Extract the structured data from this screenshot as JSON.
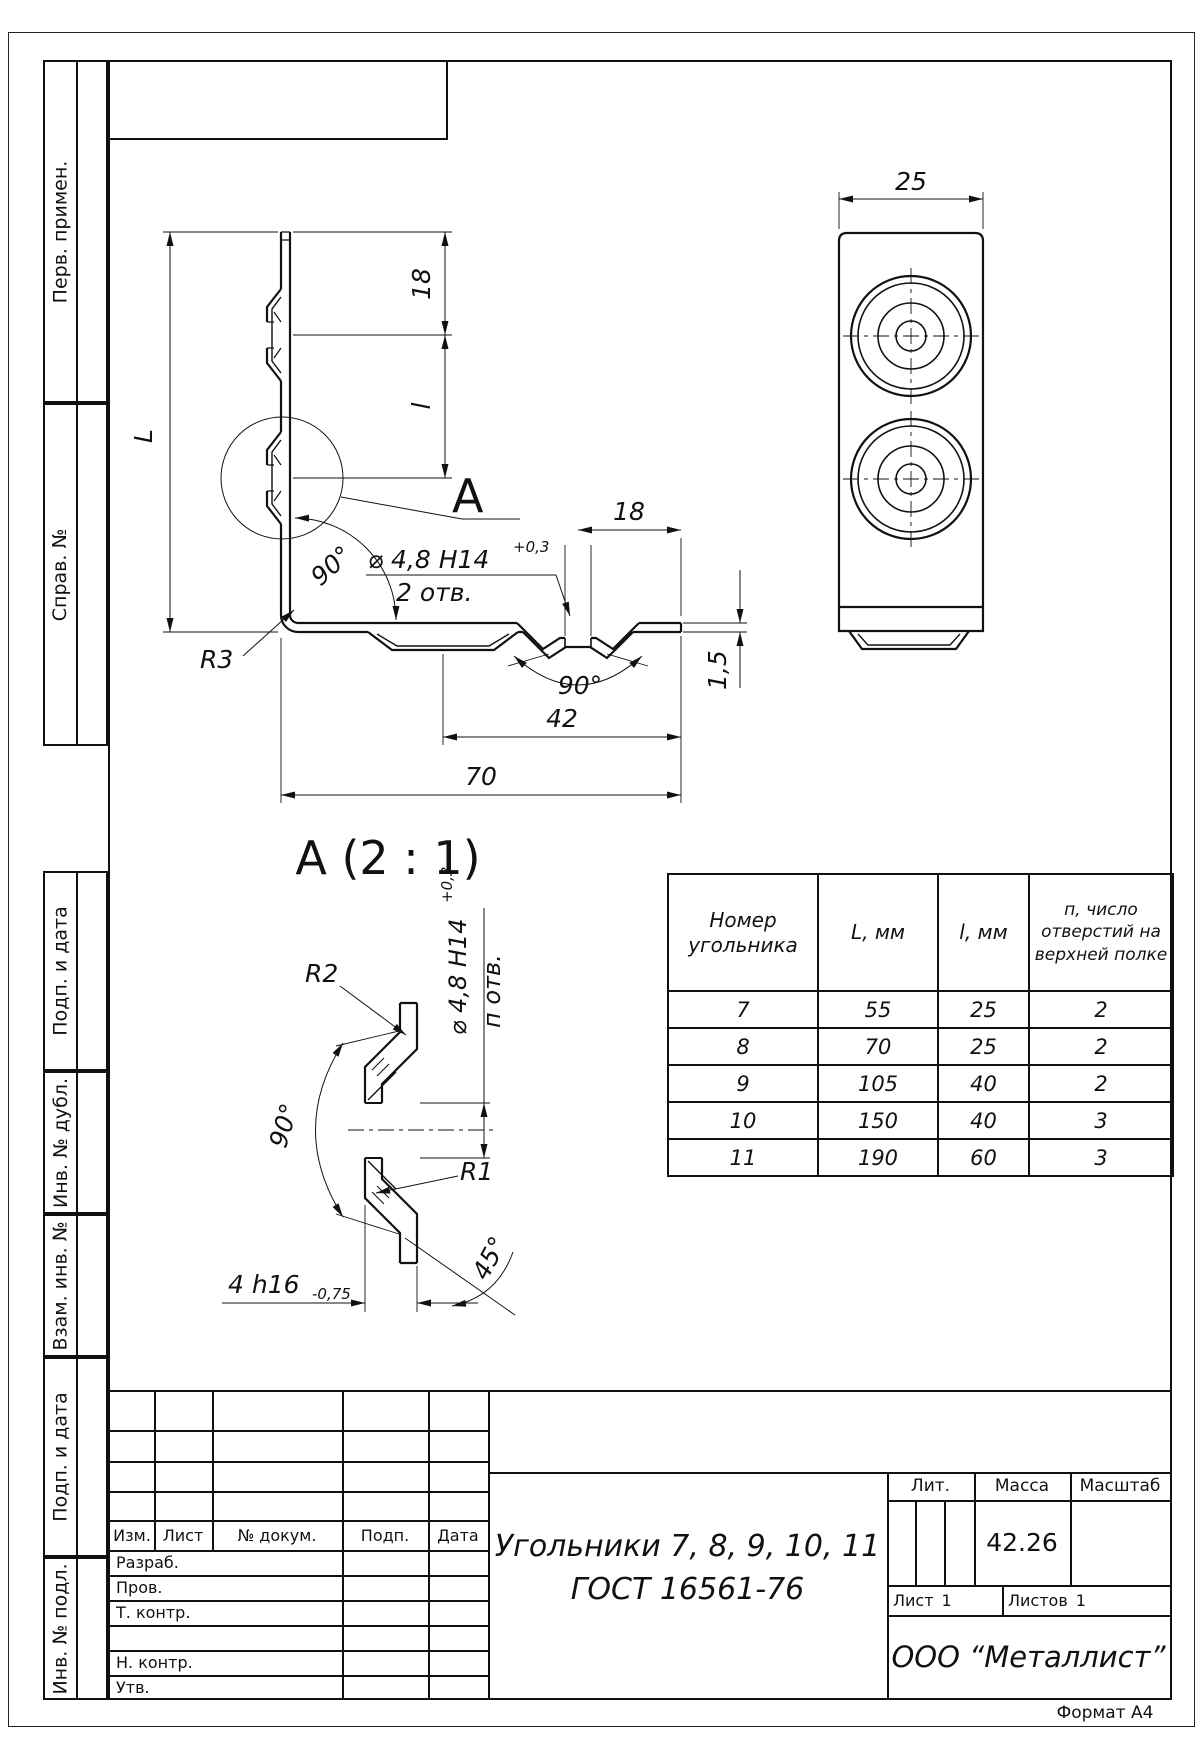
{
  "page": {
    "format_label": "Формат А4"
  },
  "left_margin": {
    "items": [
      {
        "label": "Перв. примен."
      },
      {
        "label": "Справ. №"
      },
      {
        "label": "Подп. и дата"
      },
      {
        "label": "Инв. № дубл."
      },
      {
        "label": "Взам. инв. №"
      },
      {
        "label": "Подп. и дата"
      },
      {
        "label": "Инв. № подл."
      }
    ]
  },
  "front_view": {
    "dim_L": "L",
    "dim_l": "l",
    "dim_18_top": "18",
    "dim_18_flange": "18",
    "dim_42": "42",
    "dim_70": "70",
    "dim_thickness": "1,5",
    "radius_corner": "R3",
    "angle_bend": "90°",
    "angle_countersink": "90°",
    "hole_note": {
      "diameter": "⌀ 4,8 H14",
      "tolerance": "+0,3",
      "count": "2 отв."
    },
    "detail_marker": "A"
  },
  "top_view": {
    "dim_width": "25"
  },
  "detail_view": {
    "title": "A (2 : 1)",
    "radius_outer": "R2",
    "radius_inner": "R1",
    "angle": "90°",
    "chamfer_angle": "45°",
    "hole_note": {
      "diameter": "⌀ 4,8 H14",
      "tolerance": "+0,3",
      "count": "п отв."
    },
    "depth": {
      "value": "4 h16",
      "tolerance": "-0,75"
    }
  },
  "table": {
    "headers": [
      "Номер угольника",
      "L, мм",
      "l, мм",
      "п, число отверстий на верхней полке"
    ],
    "rows": [
      [
        "7",
        "55",
        "25",
        "2"
      ],
      [
        "8",
        "70",
        "25",
        "2"
      ],
      [
        "9",
        "105",
        "40",
        "2"
      ],
      [
        "10",
        "150",
        "40",
        "3"
      ],
      [
        "11",
        "190",
        "60",
        "3"
      ]
    ]
  },
  "title_block": {
    "columns": {
      "izm": "Изм.",
      "list": "Лист",
      "doc": "№ докум.",
      "podp": "Подп.",
      "data": "Дата"
    },
    "rows": {
      "razrab": "Разраб.",
      "prov": "Пров.",
      "tkontr": "Т. контр.",
      "nkontr": "Н. контр.",
      "utv": "Утв."
    },
    "title_line1": "Угольники 7, 8, 9, 10, 11",
    "title_line2": "ГОСТ 16561-76",
    "lit_label": "Лит.",
    "mass_label": "Масса",
    "scale_label": "Масштаб",
    "mass_value": "42.26",
    "sheet_label": "Лист",
    "sheet_value": "1",
    "sheets_label": "Листов",
    "sheets_value": "1",
    "company": "ООО “Металлист”"
  }
}
